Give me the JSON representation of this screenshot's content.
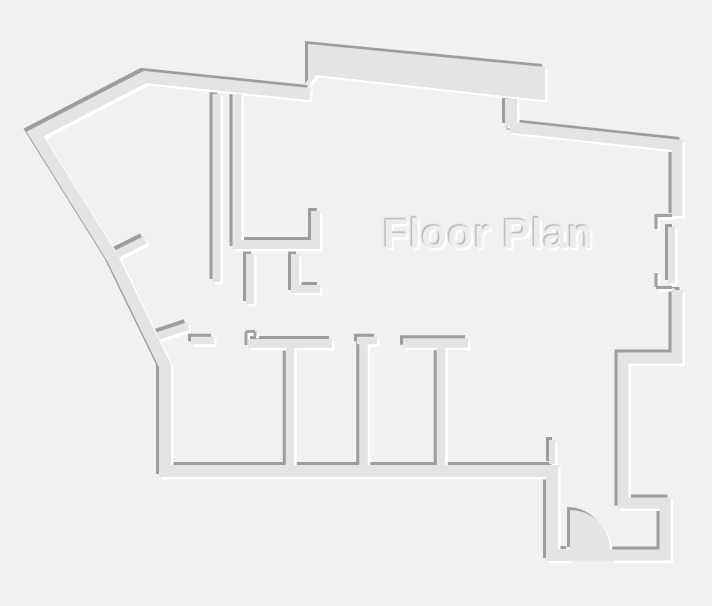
{
  "title": {
    "text": "Floor Plan"
  },
  "canvas": {
    "width": 712,
    "height": 606,
    "background": "#f0f1f1"
  },
  "palette": {
    "wall_fill": "#e3e4e5",
    "edge_dark": "#9d9d9d",
    "edge_light": "#ffffff",
    "thin_line": "#a2a2a2",
    "title_color": "#ecedee",
    "title_shadow_dark": "#b9bbbb",
    "title_shadow_light": "#ffffff"
  },
  "title_layout": {
    "x": 383,
    "y": 248,
    "size": 42
  },
  "plan": {
    "emboss": {
      "dark_dx": -3,
      "dark_dy": -3,
      "light_dx": 2.5,
      "light_dy": 2.5
    },
    "walls": [
      {
        "name": "outer-top-left-and-bottom",
        "w": 12,
        "points": [
          [
            310,
            94
          ],
          [
            145,
            77
          ],
          [
            35,
            134
          ],
          [
            113,
            259
          ],
          [
            165,
            366
          ],
          [
            165,
            471
          ],
          [
            552,
            471
          ],
          [
            552,
            555
          ],
          [
            569,
            555
          ]
        ]
      },
      {
        "name": "bump-connector",
        "w": 12,
        "points": [
          [
            511,
            99
          ],
          [
            511,
            126
          ]
        ]
      },
      {
        "name": "outer-top-right-diagonal",
        "w": 11,
        "points": [
          [
            510,
            127
          ],
          [
            677,
            145
          ],
          [
            677,
            216
          ]
        ]
      },
      {
        "name": "right-window-segment",
        "w": 7,
        "points": [
          [
            671.5,
            227
          ],
          [
            671.5,
            283
          ]
        ]
      },
      {
        "name": "outer-right-lower",
        "w": 11,
        "points": [
          [
            677,
            290
          ],
          [
            677,
            358
          ],
          [
            623,
            358
          ],
          [
            623,
            503
          ],
          [
            665,
            503
          ],
          [
            665,
            555
          ],
          [
            612,
            555
          ]
        ]
      },
      {
        "name": "vestibule-jamb-stub",
        "w": 6,
        "points": [
          [
            552,
            440
          ],
          [
            552,
            464
          ]
        ]
      },
      {
        "name": "interior-wall-a",
        "w": 8,
        "points": [
          [
            216.5,
            94
          ],
          [
            216.5,
            282
          ]
        ]
      },
      {
        "name": "interior-wall-b-counter",
        "w": 9,
        "points": [
          [
            237,
            94
          ],
          [
            237,
            244.5
          ],
          [
            315.5,
            244.5
          ],
          [
            315.5,
            211
          ]
        ]
      },
      {
        "name": "interior-stub-1",
        "w": 8,
        "points": [
          [
            250,
            254
          ],
          [
            250,
            304
          ]
        ]
      },
      {
        "name": "interior-stub-2-l",
        "w": 8,
        "points": [
          [
            295,
            254
          ],
          [
            295,
            289
          ],
          [
            320,
            289
          ]
        ]
      },
      {
        "name": "roomtop-stub-0",
        "w": 7.5,
        "points": [
          [
            191,
            340.5
          ],
          [
            214,
            340.5
          ]
        ]
      },
      {
        "name": "roomtop-wall-a",
        "w": 9,
        "points": [
          [
            248,
            343.5
          ],
          [
            332,
            343.5
          ]
        ]
      },
      {
        "name": "partition-1",
        "w": 8.5,
        "points": [
          [
            290,
            348
          ],
          [
            290,
            466
          ]
        ]
      },
      {
        "name": "roomtop-stub-b",
        "w": 7.5,
        "points": [
          [
            357,
            340.5
          ],
          [
            377,
            340.5
          ]
        ]
      },
      {
        "name": "partition-2",
        "w": 8.5,
        "points": [
          [
            363.5,
            344
          ],
          [
            363.5,
            466
          ]
        ]
      },
      {
        "name": "roomtop-wall-c",
        "w": 9.5,
        "points": [
          [
            403,
            343
          ],
          [
            468,
            343
          ]
        ]
      },
      {
        "name": "partition-3",
        "w": 8.5,
        "points": [
          [
            441,
            348
          ],
          [
            441,
            466
          ]
        ]
      },
      {
        "name": "door-leaf-1",
        "w": 8,
        "points": [
          [
            109,
            258
          ],
          [
            145,
            240
          ]
        ]
      },
      {
        "name": "door-leaf-2",
        "w": 8,
        "points": [
          [
            158,
            336
          ],
          [
            188,
            326
          ]
        ]
      }
    ],
    "shapes": [
      {
        "name": "top-bump",
        "path": "M308,44 L545,67 L545,100 L514,97 L316,75 L308,87 Z"
      },
      {
        "name": "door-swing",
        "path": "M570,510 A40,40 0 0 1 610,550 L570,550 Z"
      }
    ],
    "fill_only": [
      {
        "name": "door-opening-band",
        "w": 11,
        "points": [
          [
            564,
            555
          ],
          [
            614,
            555
          ]
        ]
      }
    ],
    "thin_lines": [
      {
        "name": "window-jamb-1a",
        "w": 3.2,
        "points": [
          [
            656,
            215.5
          ],
          [
            672,
            215.5
          ]
        ]
      },
      {
        "name": "window-jamb-1b",
        "w": 3.2,
        "points": [
          [
            656,
            214
          ],
          [
            656,
            229
          ]
        ]
      },
      {
        "name": "window-jamb-2a",
        "w": 3.2,
        "points": [
          [
            656,
            273
          ],
          [
            656,
            287
          ]
        ]
      },
      {
        "name": "window-jamb-2b",
        "w": 3.2,
        "points": [
          [
            656,
            287.5
          ],
          [
            672,
            287.5
          ]
        ]
      },
      {
        "name": "mini-jamb-a",
        "w": 3,
        "points": [
          [
            246,
            331.5
          ],
          [
            255,
            331.5
          ]
        ]
      },
      {
        "name": "mini-jamb-b",
        "w": 3,
        "points": [
          [
            246,
            331.5
          ],
          [
            246,
            345
          ]
        ]
      },
      {
        "name": "mini-jamb-c",
        "w": 3,
        "points": [
          [
            255,
            331.5
          ],
          [
            255,
            336
          ]
        ]
      }
    ]
  }
}
